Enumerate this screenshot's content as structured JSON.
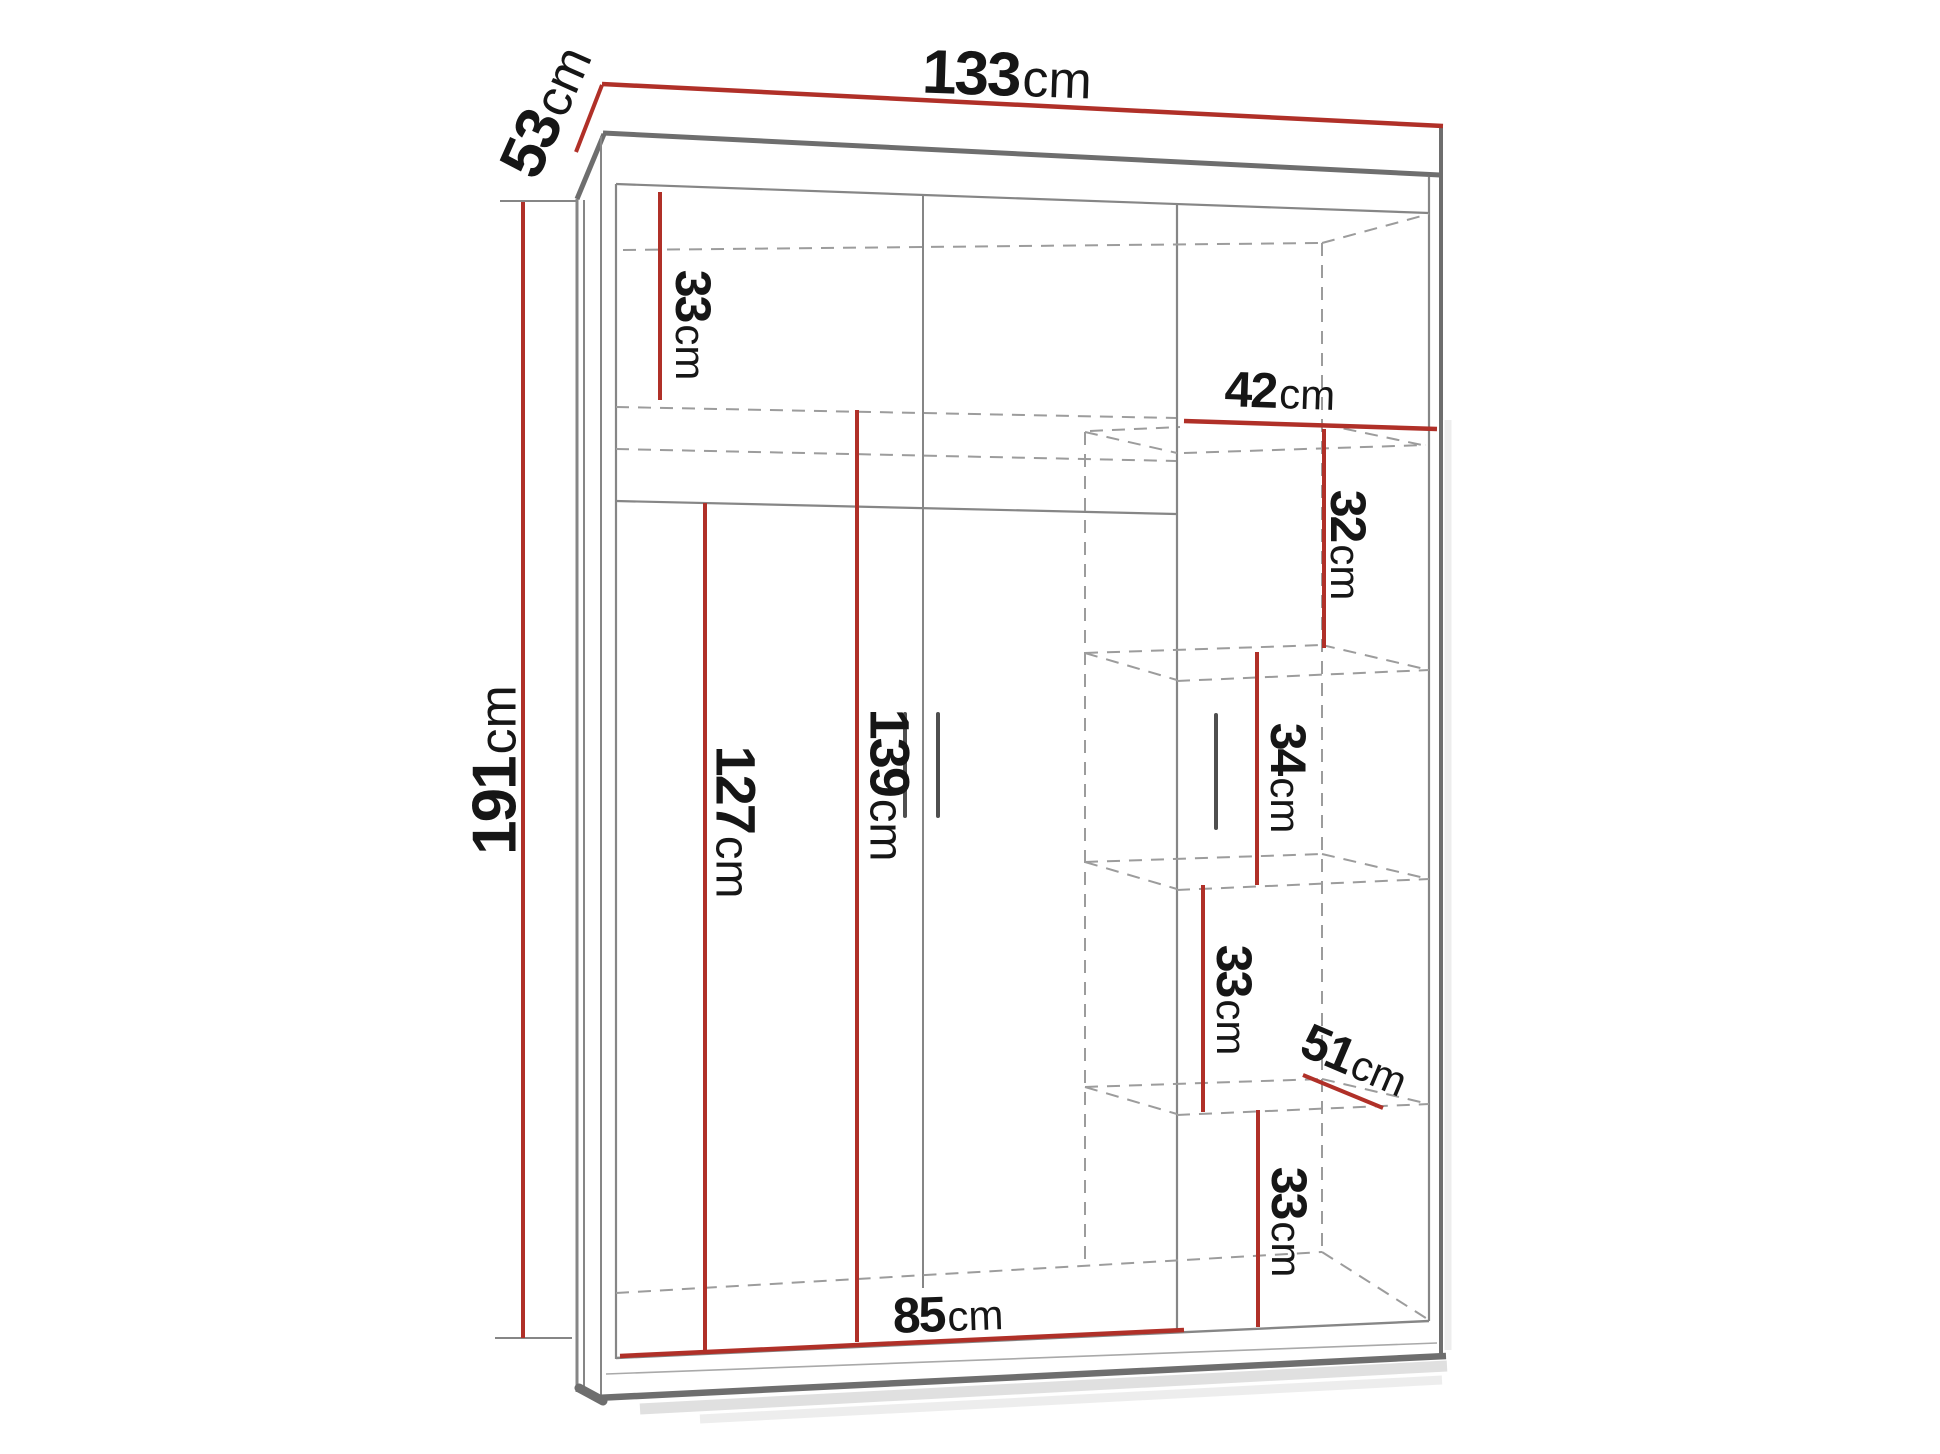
{
  "colors": {
    "dimension_red": "#b03028",
    "line_gray": "#868686",
    "text_ink": "#161616"
  },
  "dims": {
    "d133": {
      "value": "133",
      "unit": "cm"
    },
    "d53": {
      "value": "53",
      "unit": "cm"
    },
    "d191": {
      "value": "191",
      "unit": "cm"
    },
    "d33_top": {
      "value": "33",
      "unit": "cm"
    },
    "d127": {
      "value": "127",
      "unit": "cm"
    },
    "d139": {
      "value": "139",
      "unit": "cm"
    },
    "d42": {
      "value": "42",
      "unit": "cm"
    },
    "d32": {
      "value": "32",
      "unit": "cm"
    },
    "d34": {
      "value": "34",
      "unit": "cm"
    },
    "d33_mid": {
      "value": "33",
      "unit": "cm"
    },
    "d51": {
      "value": "51",
      "unit": "cm"
    },
    "d33_low": {
      "value": "33",
      "unit": "cm"
    },
    "d85": {
      "value": "85",
      "unit": "cm"
    }
  }
}
